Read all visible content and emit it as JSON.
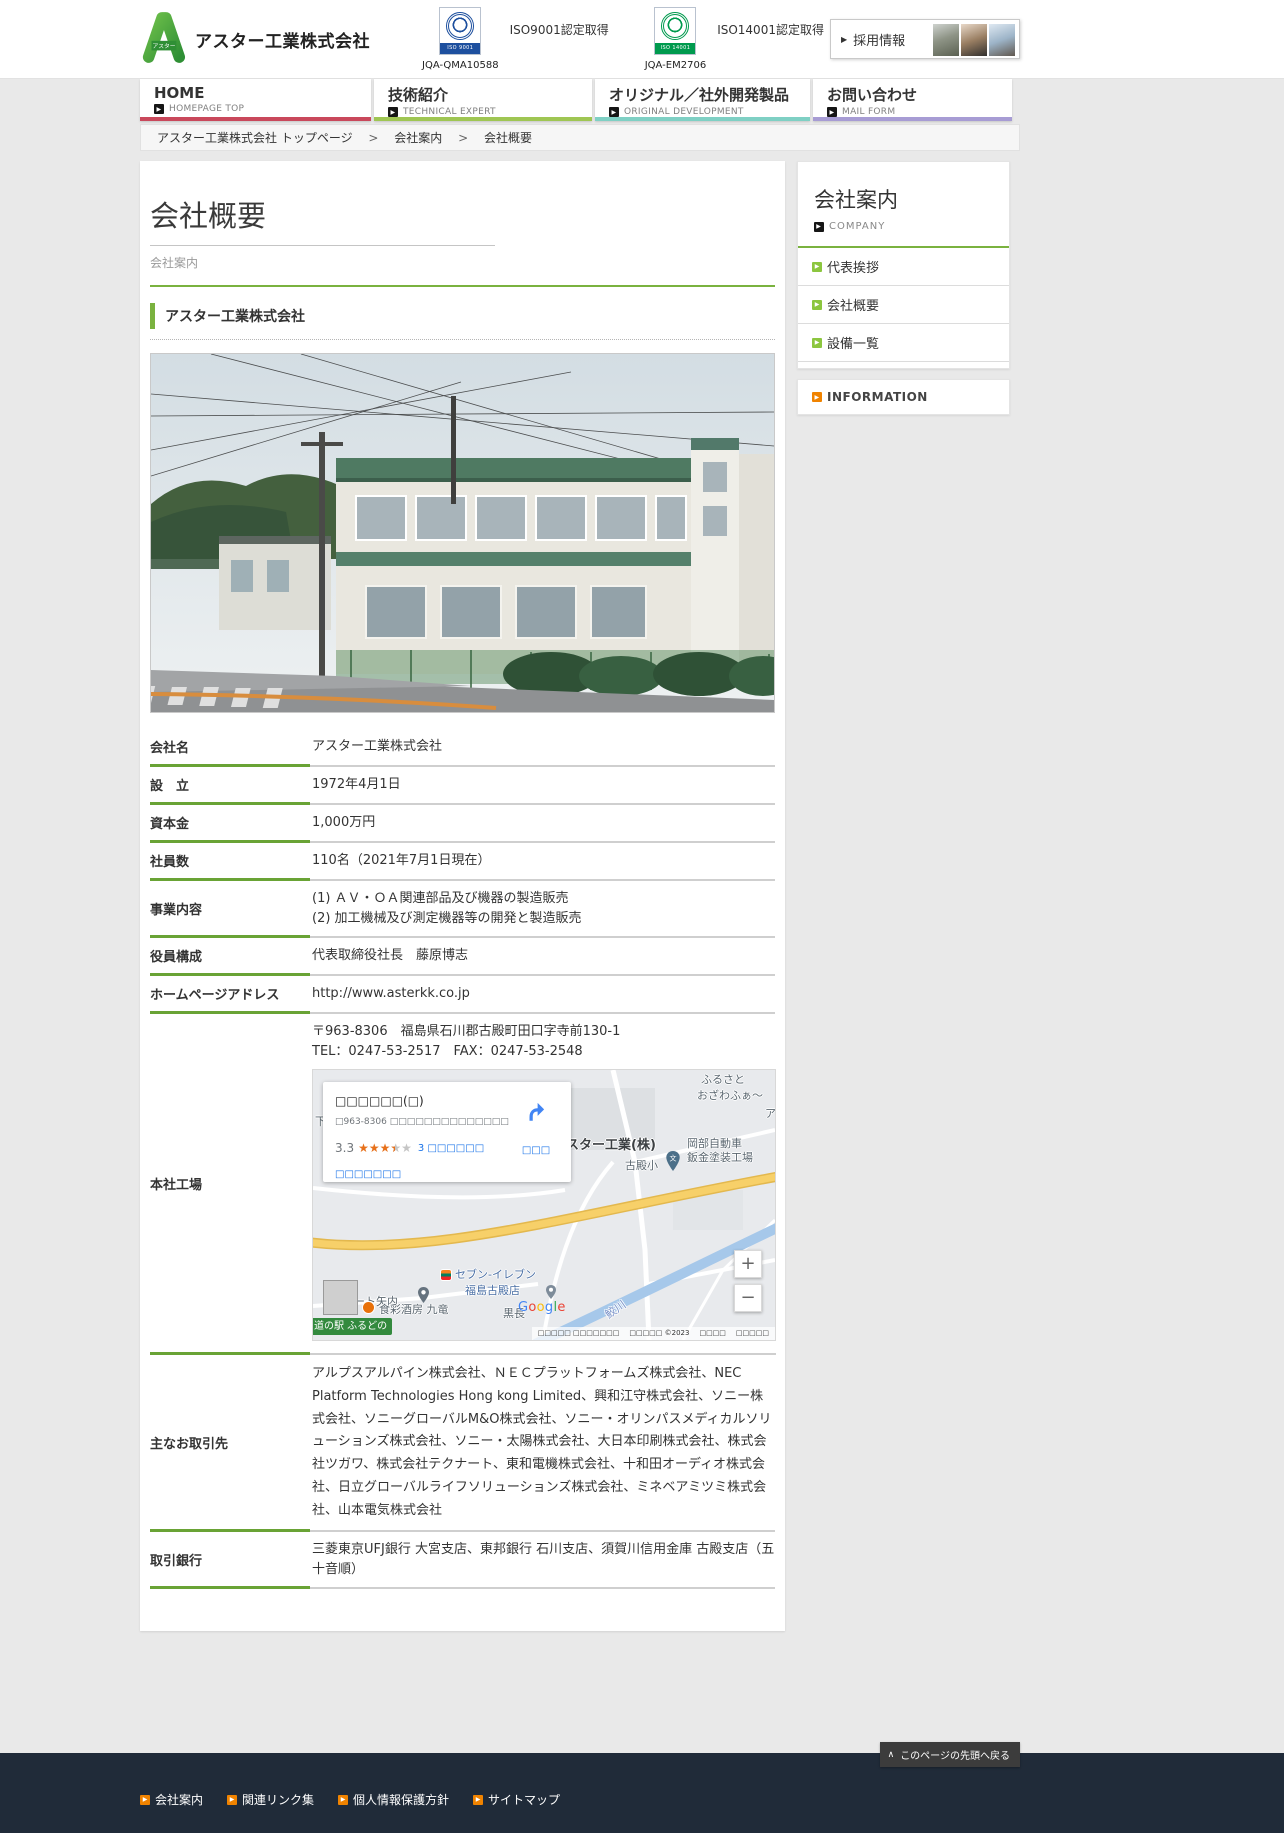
{
  "colors": {
    "accent_green": "#7ab23f",
    "table_label_green": "#69a335",
    "sidebar_arrow_green": "#8cc63f",
    "info_arrow_orange": "#f08300",
    "nav_home_red": "#c9485b",
    "nav_tech_green": "#9fc653",
    "nav_original_teal": "#7fd0c4",
    "nav_contact_purple": "#a79cd4",
    "footer_bg": "#202b39",
    "map_pin_red": "#ea4335",
    "star_orange": "#e7711b",
    "link_blue": "#1a73e8"
  },
  "header": {
    "company_name": "アスター工業株式会社",
    "iso9001_label": "ISO9001認定取得",
    "iso9001_badge": "ISO 9001",
    "iso9001_code": "JQA-QMA10588",
    "iso14001_label": "ISO14001認定取得",
    "iso14001_badge": "ISO 14001",
    "iso14001_code": "JQA-EM2706",
    "recruit_arrow": "▶",
    "recruit_label": "採用情報"
  },
  "nav": {
    "items": [
      {
        "label": "HOME",
        "sub": "HOMEPAGE TOP",
        "arrow": "▶"
      },
      {
        "label": "技術紹介",
        "sub": "TECHNICAL EXPERT",
        "arrow": "▶"
      },
      {
        "label": "オリジナル／社外開発製品",
        "sub": "ORIGINAL DEVELOPMENT",
        "arrow": "▶"
      },
      {
        "label": "お問い合わせ",
        "sub": "MAIL FORM",
        "arrow": "▶"
      }
    ]
  },
  "breadcrumb": {
    "home": "アスター工業株式会社 トップページ",
    "sep1": ">",
    "level1": "会社案内",
    "sep2": ">",
    "current": "会社概要"
  },
  "page": {
    "title": "会社概要",
    "subtitle": "会社案内",
    "section_heading": "アスター工業株式会社"
  },
  "sidebar": {
    "title": "会社案内",
    "subtitle": "COMPANY",
    "arrow": "▶",
    "items": [
      {
        "label": "代表挨拶"
      },
      {
        "label": "会社概要"
      },
      {
        "label": "設備一覧"
      }
    ],
    "information": "INFORMATION"
  },
  "company": {
    "rows": [
      {
        "label": "会社名",
        "value": "アスター工業株式会社"
      },
      {
        "label": "設　立",
        "value": "1972年4月1日"
      },
      {
        "label": "資本金",
        "value": "1,000万円"
      },
      {
        "label": "社員数",
        "value": "110名（2021年7月1日現在）"
      },
      {
        "label": "事業内容",
        "line1": "(1) ＡＶ・ＯＡ関連部品及び機器の製造販売",
        "line2": "(2) 加工機械及び測定機器等の開発と製造販売"
      },
      {
        "label": "役員構成",
        "value": "代表取締役社長　藤原博志"
      },
      {
        "label": "ホームページアドレス",
        "value": "http://www.asterkk.co.jp"
      },
      {
        "label": "本社工場",
        "address": "〒963-8306　福島県石川郡古殿町田口字寺前130-1",
        "tel_fax": "TEL：0247-53-2517　FAX：0247-53-2548"
      },
      {
        "label": "主なお取引先",
        "value": "アルプスアルパイン株式会社、ＮＥＣプラットフォームズ株式会社、NEC Platform Technologies Hong kong Limited、興和江守株式会社、ソニー株式会社、ソニーグローバルM&O株式会社、ソニー・オリンパスメディカルソリューションズ株式会社、ソニー・太陽株式会社、大日本印刷株式会社、株式会社ツガワ、株式会社テクナート、東和電機株式会社、十和田オーディオ株式会社、日立グローバルライフソリューションズ株式会社、ミネベアミツミ株式会社、山本電気株式会社"
      },
      {
        "label": "取引銀行",
        "value": "三菱東京UFJ銀行 大宮支店、東邦銀行 石川支店、須賀川信用金庫 古殿支店（五十音順）"
      }
    ]
  },
  "map": {
    "card": {
      "title": "□□□□□□(□)",
      "address": "□963-8306 □□□□□□□□□□□□□□□□□-□",
      "rating": "3.3",
      "reviews": "3 □□□□□□",
      "larger_map": "□□□□□□□",
      "route": "□□□"
    },
    "labels": {
      "furusato": "ふるさと",
      "ozawa": "おざわふぁ～",
      "partial_right": "ア",
      "partial_left": "下",
      "school": "古殿小",
      "school_glyph": "文",
      "okabe1": "岡部自動車",
      "okabe2": "鈑金塗装工場",
      "dest": "アスター工業(株)",
      "seven1": "セブン-イレブン",
      "seven2": "福島古殿店",
      "auto_yanai": "オート矢内",
      "michinoeki": "道の駅 ふるどの",
      "restaurant": "食彩酒房 九竜",
      "kurocho": "黒長",
      "river": "鮫川"
    },
    "controls": {
      "zoom_in": "+",
      "zoom_out": "−"
    },
    "google_letters": [
      "G",
      "o",
      "o",
      "g",
      "l",
      "e"
    ],
    "attribution": [
      "□□□□□ □□□□□□□",
      "□□□□□ ©2023",
      "□□□□",
      "□□□□□"
    ]
  },
  "footer": {
    "links": [
      {
        "label": "会社案内"
      },
      {
        "label": "関連リンク集"
      },
      {
        "label": "個人情報保護方針"
      },
      {
        "label": "サイトマップ"
      }
    ],
    "back_icon": "∧",
    "back_to_top": "このページの先頭へ戻る"
  }
}
